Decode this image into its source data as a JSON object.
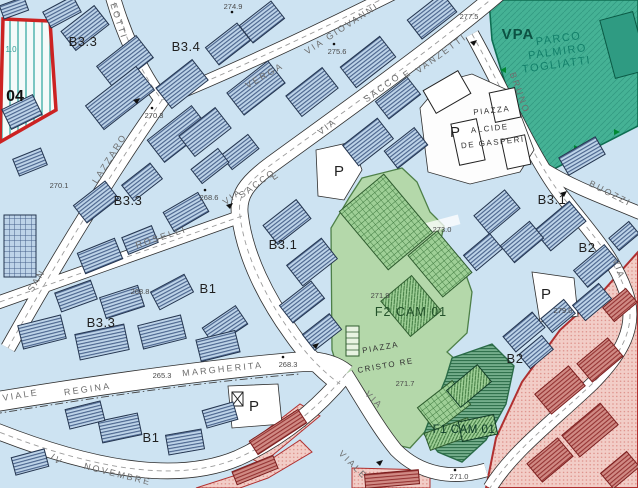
{
  "labels": {
    "zones": [
      "B3.3",
      "B3.4",
      "B3.3",
      "B3.3",
      "B3.1",
      "B1",
      "B1",
      "B3.1",
      "B2",
      "B2",
      "04",
      "1.0"
    ],
    "areas": [
      "VPA",
      "PARCO",
      "PALMIRO",
      "TOGLIATTI",
      "F2 CAM 01",
      "F1 CAM 01",
      "PIAZZA",
      "ALCIDE",
      "DE GASPERI",
      "PIAZZA",
      "CRISTO RE"
    ],
    "streets": [
      "GIOVANNI",
      "VIA",
      "VERGA",
      "EOTTI",
      "VIA",
      "SACCO",
      "E",
      "VANZETTI",
      "VIA",
      "SACCO",
      "E",
      "SAN",
      "LAZZARO",
      "ROSELLI",
      "BRUNO",
      "BUOZZI",
      "VIA",
      "VIA",
      "VIALE",
      "VIALE",
      "REGINA",
      "MARGHERITA",
      "IV",
      "NOVEMBRE"
    ],
    "elevations": [
      "274.9",
      "275.6",
      "277.5",
      "270.3",
      "270.1",
      "268.6",
      "268.8",
      "265.3",
      "268.3",
      "271.9",
      "273.0",
      "271.7",
      "271.0",
      "279.0"
    ],
    "parking": [
      "P",
      "P",
      "P",
      "P"
    ]
  },
  "colors": {
    "background": "#cde3f2",
    "building_fill": "#bdd3e8",
    "building_hatch": "#46608a",
    "park_green": "#45b295",
    "zone_f2_green": "#b4d8aa",
    "zone_f1_green": "#74ad8b",
    "red_zone_fill": "#f2cdc7",
    "red_zone_building": "#d08a84",
    "zone_04_border": "#cc2222",
    "street_white": "#ffffff"
  }
}
